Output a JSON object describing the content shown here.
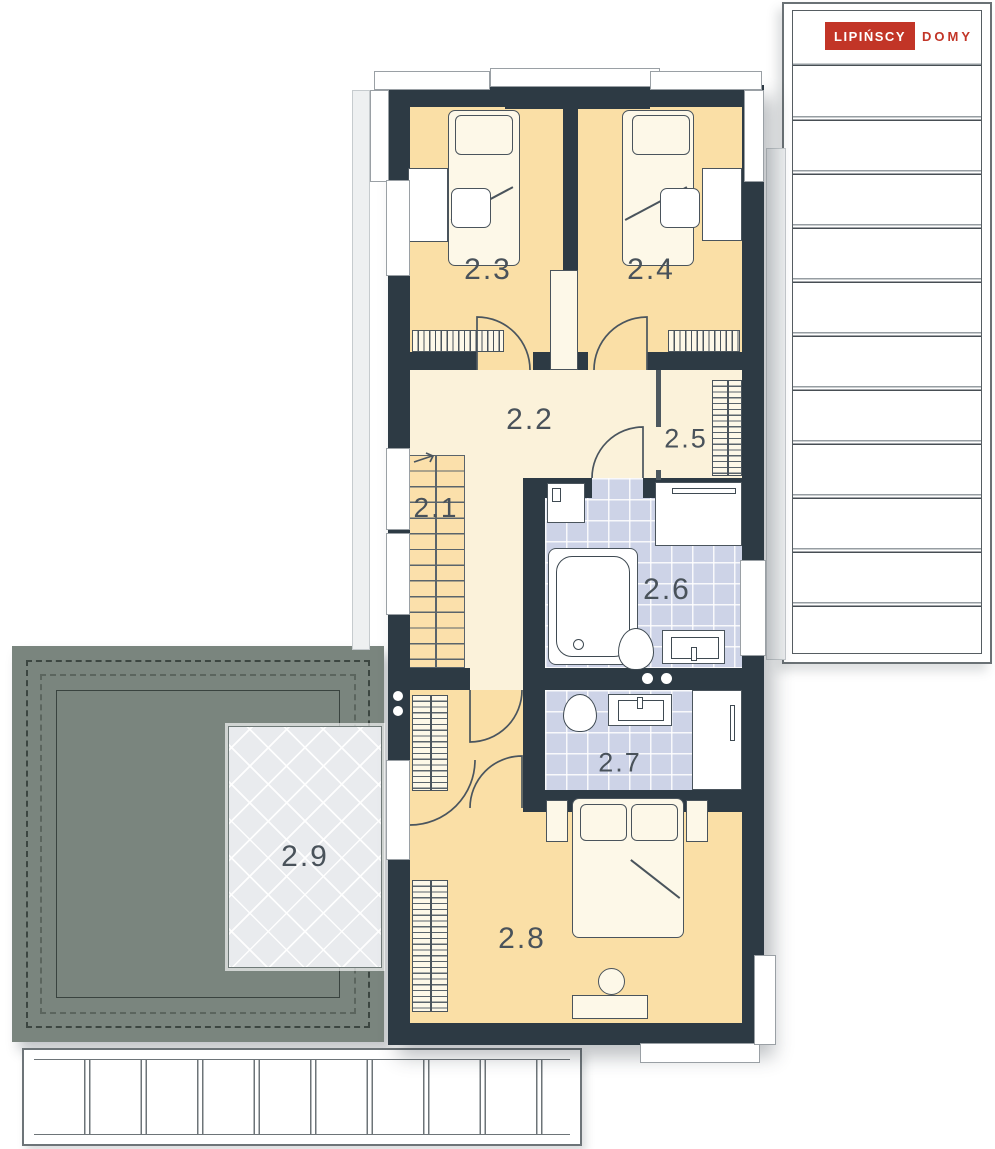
{
  "brand": {
    "primary": "LIPIŃSCY",
    "secondary": "DOMY",
    "logo_bg": "#c23527",
    "logo_text": "#ffffff"
  },
  "rooms": [
    {
      "id": "2.1",
      "label": "2.1",
      "type": "staircase"
    },
    {
      "id": "2.2",
      "label": "2.2",
      "type": "hallway"
    },
    {
      "id": "2.3",
      "label": "2.3",
      "type": "bedroom"
    },
    {
      "id": "2.4",
      "label": "2.4",
      "type": "bedroom"
    },
    {
      "id": "2.5",
      "label": "2.5",
      "type": "wardrobe"
    },
    {
      "id": "2.6",
      "label": "2.6",
      "type": "bathroom"
    },
    {
      "id": "2.7",
      "label": "2.7",
      "type": "bathroom"
    },
    {
      "id": "2.8",
      "label": "2.8",
      "type": "bedroom"
    },
    {
      "id": "2.9",
      "label": "2.9",
      "type": "roof-terrace"
    }
  ],
  "palette": {
    "wall": "#2d3a44",
    "bedroom_floor": "#fadfa6",
    "hall_floor": "#fbf2da",
    "bath_tile": "#cdd3e7",
    "roof_gray": "#7a857e",
    "terrace_glass": "#e9ebee",
    "label_text": "#49525a"
  }
}
